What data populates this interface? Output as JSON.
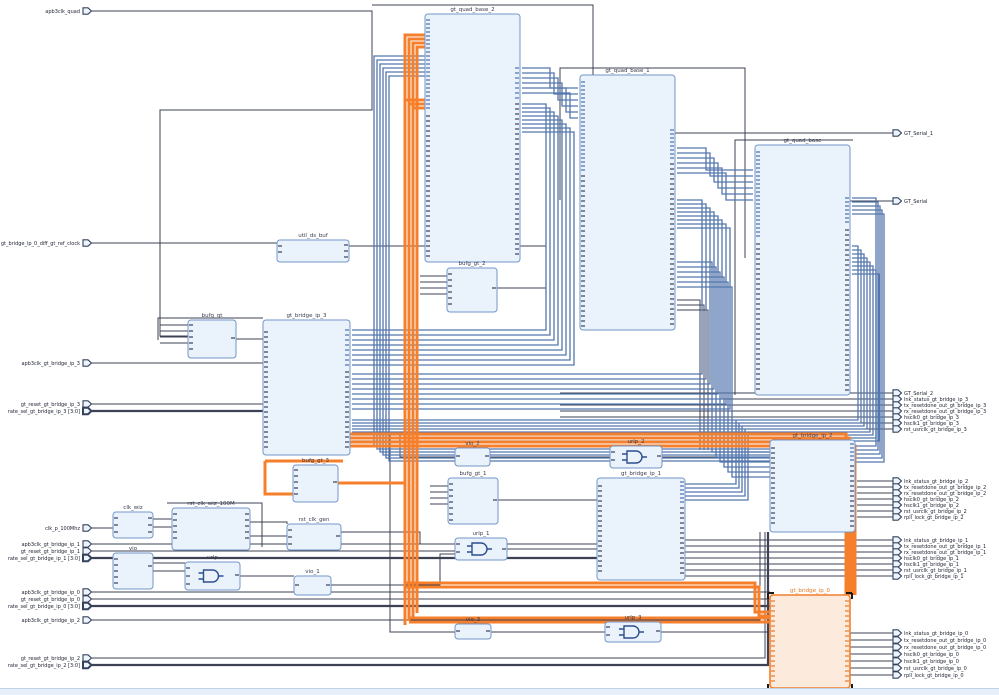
{
  "app": {
    "view": "elaborated-design-schematic",
    "highlight_color": "#f57f2b",
    "net_color": "#3c4254",
    "bundle_color": "#5377ad",
    "block_fill": "#eaf2fb",
    "block_border": "#7396c8",
    "selected_fill": "#fcebdc",
    "selected_border": "#f07f2e"
  },
  "blocks": [
    {
      "id": "gt_quad_base_2",
      "label": "gt_quad_base_2",
      "kind": "quad",
      "selected": false
    },
    {
      "id": "gt_quad_base_1",
      "label": "gt_quad_base_1",
      "kind": "quad",
      "selected": false
    },
    {
      "id": "gt_quad_base",
      "label": "gt_quad_base",
      "kind": "quad",
      "selected": false
    },
    {
      "id": "util_ds_buf",
      "label": "util_ds_buf",
      "kind": "small",
      "selected": false
    },
    {
      "id": "bufg_gt",
      "label": "bufg_gt",
      "kind": "buf",
      "selected": false
    },
    {
      "id": "gt_bridge_ip_3",
      "label": "gt_bridge_ip_3",
      "kind": "bridge",
      "selected": false
    },
    {
      "id": "bufg_gt_2",
      "label": "bufg_gt_2",
      "kind": "buf",
      "selected": false
    },
    {
      "id": "bufg_gt_3",
      "label": "bufg_gt_3",
      "kind": "buf",
      "selected": false
    },
    {
      "id": "vio_2",
      "label": "vio_2",
      "kind": "tiny",
      "selected": false
    },
    {
      "id": "urlp_2",
      "label": "urlp_2",
      "kind": "gate",
      "selected": false
    },
    {
      "id": "bufg_gt_1",
      "label": "bufg_gt_1",
      "kind": "buf",
      "selected": false
    },
    {
      "id": "urlp_1",
      "label": "urlp_1",
      "kind": "gate",
      "selected": false
    },
    {
      "id": "gt_bridge_ip_1",
      "label": "gt_bridge_ip_1",
      "kind": "bridge",
      "selected": false
    },
    {
      "id": "gt_bridge_ip_2",
      "label": "gt_bridge_ip_2",
      "kind": "bridge",
      "selected": false
    },
    {
      "id": "clk_wiz",
      "label": "clk_wiz",
      "kind": "small",
      "selected": false
    },
    {
      "id": "rst_clk_wiz_100M",
      "label": "rst_clk_wiz_100M",
      "kind": "med",
      "selected": false
    },
    {
      "id": "rst_clk_gen",
      "label": "rst_clk_gen",
      "kind": "small",
      "selected": false
    },
    {
      "id": "vio",
      "label": "vio",
      "kind": "small",
      "selected": false
    },
    {
      "id": "urlp",
      "label": "urlp",
      "kind": "gate",
      "selected": false
    },
    {
      "id": "vio_1",
      "label": "vio_1",
      "kind": "tiny",
      "selected": false
    },
    {
      "id": "vio_3",
      "label": "vio_3",
      "kind": "tiny",
      "selected": false
    },
    {
      "id": "urlp_3",
      "label": "urlp_3",
      "kind": "gate",
      "selected": false
    },
    {
      "id": "gt_bridge_ip_0",
      "label": "gt_bridge_ip_0",
      "kind": "bridge",
      "selected": true
    }
  ],
  "left_ports": [
    {
      "label": "apb3clk_quad",
      "bus": false
    },
    {
      "label": "gt_bridge_ip_0_diff_gt_ref_clock",
      "bus": false
    },
    {
      "label": "apb3clk_gt_bridge_ip_3",
      "bus": false
    },
    {
      "label": "gt_reset_gt_bridge_ip_3",
      "bus": false
    },
    {
      "label": "rate_sel_gt_bridge_ip_3 [3:0]",
      "bus": true
    },
    {
      "label": "clk_p_100Mhz",
      "bus": false
    },
    {
      "label": "apb3clk_gt_bridge_ip_1",
      "bus": false
    },
    {
      "label": "gt_reset_gt_bridge_ip_1",
      "bus": false
    },
    {
      "label": "rate_sel_gt_bridge_ip_1 [3:0]",
      "bus": true
    },
    {
      "label": "apb3clk_gt_bridge_ip_0",
      "bus": false
    },
    {
      "label": "gt_reset_gt_bridge_ip_0",
      "bus": false
    },
    {
      "label": "rate_sel_gt_bridge_ip_0 [3:0]",
      "bus": true
    },
    {
      "label": "apb3clk_gt_bridge_ip_2",
      "bus": false
    },
    {
      "label": "gt_reset_gt_bridge_ip_2",
      "bus": false
    },
    {
      "label": "rate_sel_gt_bridge_ip_2 [3:0]",
      "bus": true
    }
  ],
  "right_ports": [
    {
      "label": "GT_Serial_1",
      "bus": false
    },
    {
      "label": "GT_Serial",
      "bus": false
    },
    {
      "label": "GT_Serial_2",
      "bus": false
    },
    {
      "label": "lnk_status_gt_bridge_ip_3",
      "bus": false
    },
    {
      "label": "tx_resetdone_out_gt_bridge_ip_3",
      "bus": false
    },
    {
      "label": "rx_resetdone_out_gt_bridge_ip_3",
      "bus": false
    },
    {
      "label": "hsclk0_gt_bridge_ip_3",
      "bus": false
    },
    {
      "label": "hsclk1_gt_bridge_ip_3",
      "bus": false
    },
    {
      "label": "rst_usrclk_gt_bridge_ip_3",
      "bus": false
    },
    {
      "label": "lnk_status_gt_bridge_ip_2",
      "bus": false
    },
    {
      "label": "tx_resetdone_out_gt_bridge_ip_2",
      "bus": false
    },
    {
      "label": "rx_resetdone_out_gt_bridge_ip_2",
      "bus": false
    },
    {
      "label": "hsclk0_gt_bridge_ip_2",
      "bus": false
    },
    {
      "label": "hsclk1_gt_bridge_ip_2",
      "bus": false
    },
    {
      "label": "rst_usrclk_gt_bridge_ip_2",
      "bus": false
    },
    {
      "label": "rpll_lock_gt_bridge_ip_2",
      "bus": false
    },
    {
      "label": "lnk_status_gt_bridge_ip_1",
      "bus": false
    },
    {
      "label": "tx_resetdone_out_gt_bridge_ip_1",
      "bus": false
    },
    {
      "label": "rx_resetdone_out_gt_bridge_ip_1",
      "bus": false
    },
    {
      "label": "hsclk0_gt_bridge_ip_1",
      "bus": false
    },
    {
      "label": "hsclk1_gt_bridge_ip_1",
      "bus": false
    },
    {
      "label": "rst_usrclk_gt_bridge_ip_1",
      "bus": false
    },
    {
      "label": "rpll_lock_gt_bridge_ip_1",
      "bus": false
    },
    {
      "label": "lnk_status_gt_bridge_ip_0",
      "bus": false
    },
    {
      "label": "tx_resetdone_out_gt_bridge_ip_0",
      "bus": false
    },
    {
      "label": "rx_resetdone_out_gt_bridge_ip_0",
      "bus": false
    },
    {
      "label": "hsclk0_gt_bridge_ip_0",
      "bus": false
    },
    {
      "label": "hsclk1_gt_bridge_ip_0",
      "bus": false
    },
    {
      "label": "rst_usrclk_gt_bridge_ip_0",
      "bus": false
    },
    {
      "label": "rpll_lock_gt_bridge_ip_0",
      "bus": false
    }
  ]
}
